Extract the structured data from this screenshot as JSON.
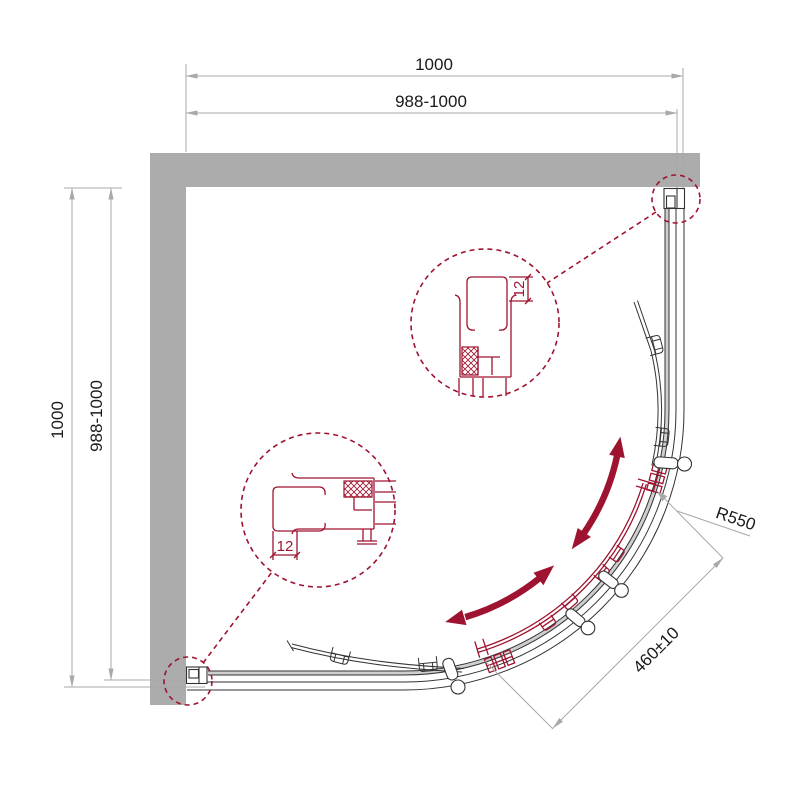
{
  "drawing": {
    "dimensions": {
      "top": {
        "overall": "1000",
        "adjustable": "988-1000"
      },
      "left": {
        "overall": "1000",
        "adjustable": "988-1000"
      },
      "radius": "R550",
      "door_opening": "460±10",
      "profile_top": "12",
      "profile_left": "12"
    },
    "colors": {
      "wall": "#acacac",
      "line": "#333333",
      "accent": "#9e1430",
      "dimension": "#a9a9a9",
      "glass_fill": "#cfcfcf"
    }
  }
}
